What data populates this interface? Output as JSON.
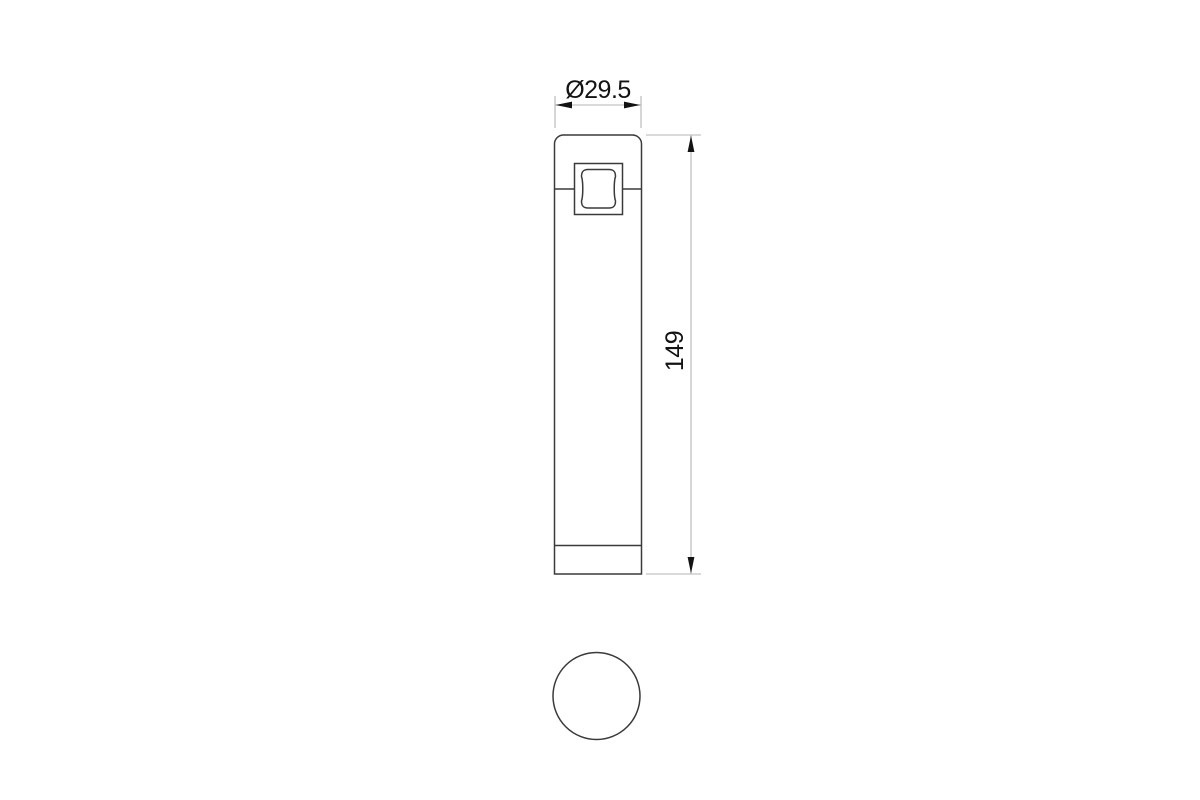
{
  "drawing": {
    "colors": {
      "background": "#ffffff",
      "outline": "#3a3a3a",
      "dim_line": "#b5b5b5",
      "arrow": "#131313",
      "text": "#131313"
    },
    "dimensions": {
      "diameter_label": "Ø29.5",
      "height_label": "149"
    }
  }
}
